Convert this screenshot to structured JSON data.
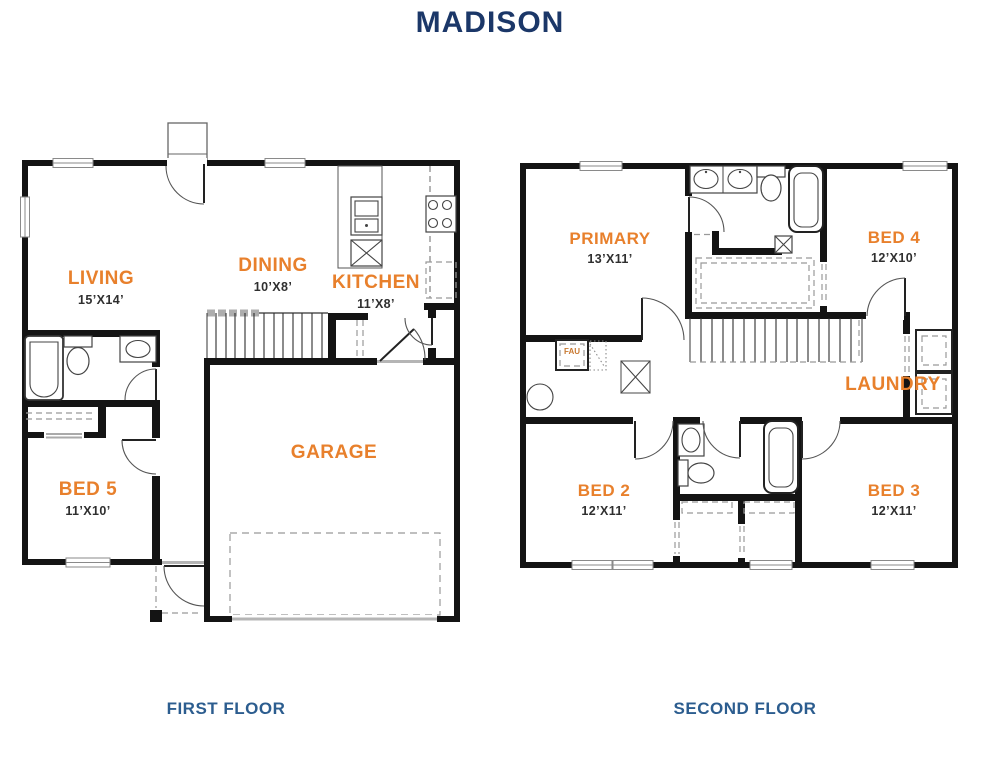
{
  "title": "MADISON",
  "floors": {
    "first": {
      "caption": "FIRST FLOOR",
      "rooms": {
        "living": {
          "name": "LIVING",
          "dims": "15’X14’"
        },
        "dining": {
          "name": "DINING",
          "dims": "10’X8’"
        },
        "kitchen": {
          "name": "KITCHEN",
          "dims": "11’X8’"
        },
        "garage": {
          "name": "GARAGE"
        },
        "bed5": {
          "name": "BED 5",
          "dims": "11’X10’"
        }
      }
    },
    "second": {
      "caption": "SECOND FLOOR",
      "rooms": {
        "primary": {
          "name": "PRIMARY",
          "dims": "13’X11’"
        },
        "bed4": {
          "name": "BED 4",
          "dims": "12’X10’"
        },
        "laundry": {
          "name": "LAUNDRY"
        },
        "bed2": {
          "name": "BED 2",
          "dims": "12’X11’"
        },
        "bed3": {
          "name": "BED 3",
          "dims": "12’X11’"
        }
      }
    }
  },
  "annotations": {
    "fau": "FAU"
  },
  "colors": {
    "orange": "#e8802c",
    "navy": "#1b3768",
    "caption": "#2c5d8f"
  }
}
